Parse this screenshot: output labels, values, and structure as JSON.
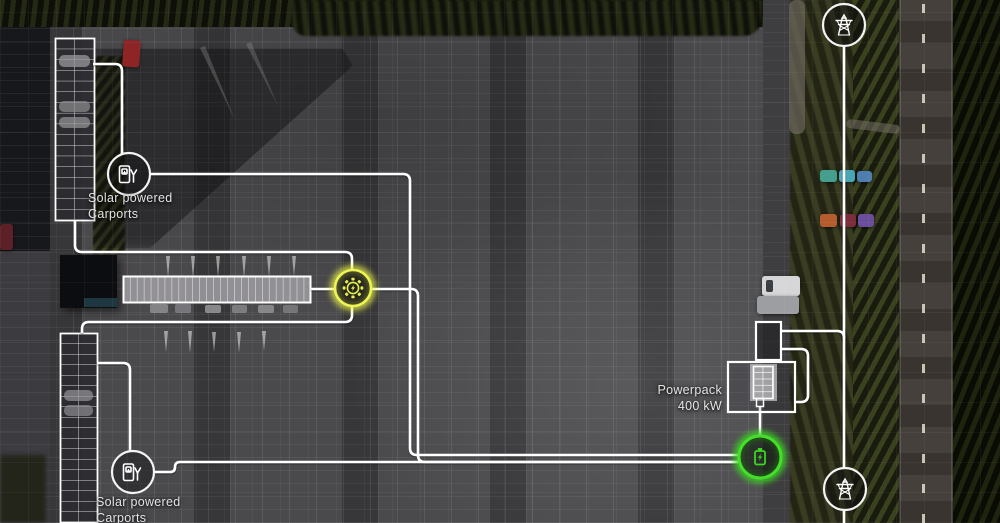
{
  "labels": {
    "carport_top": {
      "line1": "Solar powered",
      "line2": "Carports"
    },
    "carport_bottom": {
      "line1": "Solar powered",
      "line2": "Carports"
    },
    "powerpack": {
      "line1": "Powerpack",
      "line2": "400 kW"
    }
  },
  "icons": {
    "carport_top": "ev-charger-icon",
    "carport_bottom": "ev-charger-icon",
    "solar_generation": "sun-bolt-icon",
    "battery_storage": "battery-bolt-icon",
    "grid_top": "transmission-tower-icon",
    "grid_bottom": "transmission-tower-icon"
  },
  "colors": {
    "cable_line": "#ffffff",
    "solar_accent": "#e9f148",
    "battery_accent": "#3bd620",
    "label_text": "#e3e3e3"
  }
}
